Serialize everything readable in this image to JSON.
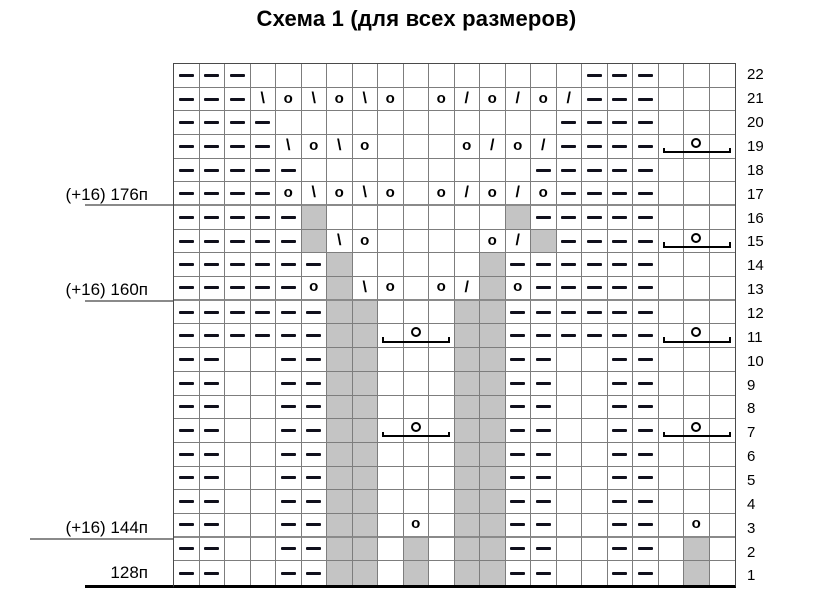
{
  "title": "Схема 1 (для всех размеров)",
  "stitch_labels": [
    {
      "text": "(+16) 176п",
      "attach_row": 17
    },
    {
      "text": "(+16) 160п",
      "attach_row": 13
    },
    {
      "text": "(+16) 144п",
      "attach_row": 3
    },
    {
      "text": "128п",
      "attach_row": 1
    }
  ],
  "symbols_legend": {
    "p": "purl-dash",
    "": "knit-empty",
    "o": "yarn-over",
    "ld": "left-leaning-decrease-backslash",
    "rd": "right-leaning-decrease-slash",
    "ns": "no-stitch-gray",
    "cl": "cluster-bracket-left",
    "cm": "cluster-bracket-middle-with-circle",
    "cr": "cluster-bracket-right"
  },
  "colors": {
    "no_stitch_fill": "#c4c4c4",
    "grid_line": "#7d7d7d",
    "separator_line": "#8a8a8a",
    "symbol": "#000000",
    "background": "#ffffff"
  },
  "grid": {
    "column_count": 22,
    "row_count": 22,
    "separator_after_rows": [
      17,
      13,
      3
    ],
    "rows": [
      {
        "number": 22,
        "cells": [
          "p",
          "p",
          "p",
          "",
          "",
          "",
          "",
          "",
          "",
          "",
          "",
          "",
          "",
          "",
          "",
          "",
          "p",
          "p",
          "p",
          "",
          "",
          ""
        ]
      },
      {
        "number": 21,
        "cells": [
          "p",
          "p",
          "p",
          "ld",
          "o",
          "ld",
          "o",
          "ld",
          "o",
          "",
          "o",
          "rd",
          "o",
          "rd",
          "o",
          "rd",
          "p",
          "p",
          "p",
          "",
          "",
          ""
        ]
      },
      {
        "number": 20,
        "cells": [
          "p",
          "p",
          "p",
          "p",
          "",
          "",
          "",
          "",
          "",
          "",
          "",
          "",
          "",
          "",
          "",
          "p",
          "p",
          "p",
          "p",
          "",
          "",
          ""
        ]
      },
      {
        "number": 19,
        "cells": [
          "p",
          "p",
          "p",
          "p",
          "ld",
          "o",
          "ld",
          "o",
          "",
          "",
          "",
          "o",
          "rd",
          "o",
          "rd",
          "p",
          "p",
          "p",
          "p",
          "cl",
          "cm",
          "cr"
        ]
      },
      {
        "number": 18,
        "cells": [
          "p",
          "p",
          "p",
          "p",
          "p",
          "",
          "",
          "",
          "",
          "",
          "",
          "",
          "",
          "",
          "p",
          "p",
          "p",
          "p",
          "p",
          "",
          "",
          ""
        ]
      },
      {
        "number": 17,
        "cells": [
          "p",
          "p",
          "p",
          "p",
          "o",
          "ld",
          "o",
          "ld",
          "o",
          "",
          "o",
          "rd",
          "o",
          "rd",
          "o",
          "p",
          "p",
          "p",
          "p",
          "",
          "",
          ""
        ]
      },
      {
        "number": 16,
        "cells": [
          "p",
          "p",
          "p",
          "p",
          "p",
          "ns",
          "",
          "",
          "",
          "",
          "",
          "",
          "",
          "ns",
          "p",
          "p",
          "p",
          "p",
          "p",
          "",
          "",
          ""
        ]
      },
      {
        "number": 15,
        "cells": [
          "p",
          "p",
          "p",
          "p",
          "p",
          "ns",
          "ld",
          "o",
          "",
          "",
          "",
          "",
          "o",
          "rd",
          "ns",
          "p",
          "p",
          "p",
          "p",
          "cl",
          "cm",
          "cr"
        ]
      },
      {
        "number": 14,
        "cells": [
          "p",
          "p",
          "p",
          "p",
          "p",
          "p",
          "ns",
          "",
          "",
          "",
          "",
          "",
          "ns",
          "p",
          "p",
          "p",
          "p",
          "p",
          "p",
          "",
          "",
          ""
        ]
      },
      {
        "number": 13,
        "cells": [
          "p",
          "p",
          "p",
          "p",
          "p",
          "o",
          "ns",
          "ld",
          "o",
          "",
          "o",
          "rd",
          "ns",
          "o",
          "p",
          "p",
          "p",
          "p",
          "p",
          "",
          "",
          ""
        ]
      },
      {
        "number": 12,
        "cells": [
          "p",
          "p",
          "p",
          "p",
          "p",
          "p",
          "ns",
          "ns",
          "",
          "",
          "",
          "ns",
          "ns",
          "p",
          "p",
          "p",
          "p",
          "p",
          "p",
          "",
          "",
          ""
        ]
      },
      {
        "number": 11,
        "cells": [
          "p",
          "p",
          "p",
          "p",
          "p",
          "p",
          "ns",
          "ns",
          "cl",
          "cm",
          "cr",
          "ns",
          "ns",
          "p",
          "p",
          "p",
          "p",
          "p",
          "p",
          "cl",
          "cm",
          "cr"
        ]
      },
      {
        "number": 10,
        "cells": [
          "p",
          "p",
          "",
          "",
          "p",
          "p",
          "ns",
          "ns",
          "",
          "",
          "",
          "ns",
          "ns",
          "p",
          "p",
          "",
          "",
          "p",
          "p",
          "",
          "",
          ""
        ]
      },
      {
        "number": 9,
        "cells": [
          "p",
          "p",
          "",
          "",
          "p",
          "p",
          "ns",
          "ns",
          "",
          "",
          "",
          "ns",
          "ns",
          "p",
          "p",
          "",
          "",
          "p",
          "p",
          "",
          "",
          ""
        ]
      },
      {
        "number": 8,
        "cells": [
          "p",
          "p",
          "",
          "",
          "p",
          "p",
          "ns",
          "ns",
          "",
          "",
          "",
          "ns",
          "ns",
          "p",
          "p",
          "",
          "",
          "p",
          "p",
          "",
          "",
          ""
        ]
      },
      {
        "number": 7,
        "cells": [
          "p",
          "p",
          "",
          "",
          "p",
          "p",
          "ns",
          "ns",
          "cl",
          "cm",
          "cr",
          "ns",
          "ns",
          "p",
          "p",
          "",
          "",
          "p",
          "p",
          "cl",
          "cm",
          "cr"
        ]
      },
      {
        "number": 6,
        "cells": [
          "p",
          "p",
          "",
          "",
          "p",
          "p",
          "ns",
          "ns",
          "",
          "",
          "",
          "ns",
          "ns",
          "p",
          "p",
          "",
          "",
          "p",
          "p",
          "",
          "",
          ""
        ]
      },
      {
        "number": 5,
        "cells": [
          "p",
          "p",
          "",
          "",
          "p",
          "p",
          "ns",
          "ns",
          "",
          "",
          "",
          "ns",
          "ns",
          "p",
          "p",
          "",
          "",
          "p",
          "p",
          "",
          "",
          ""
        ]
      },
      {
        "number": 4,
        "cells": [
          "p",
          "p",
          "",
          "",
          "p",
          "p",
          "ns",
          "ns",
          "",
          "",
          "",
          "ns",
          "ns",
          "p",
          "p",
          "",
          "",
          "p",
          "p",
          "",
          "",
          ""
        ]
      },
      {
        "number": 3,
        "cells": [
          "p",
          "p",
          "",
          "",
          "p",
          "p",
          "ns",
          "ns",
          "",
          "o",
          "",
          "ns",
          "ns",
          "p",
          "p",
          "",
          "",
          "p",
          "p",
          "",
          "o",
          ""
        ]
      },
      {
        "number": 2,
        "cells": [
          "p",
          "p",
          "",
          "",
          "p",
          "p",
          "ns",
          "ns",
          "",
          "ns",
          "",
          "ns",
          "ns",
          "p",
          "p",
          "",
          "",
          "p",
          "p",
          "",
          "ns",
          ""
        ]
      },
      {
        "number": 1,
        "cells": [
          "p",
          "p",
          "",
          "",
          "p",
          "p",
          "ns",
          "ns",
          "",
          "ns",
          "",
          "ns",
          "ns",
          "p",
          "p",
          "",
          "",
          "p",
          "p",
          "",
          "ns",
          ""
        ]
      }
    ]
  }
}
